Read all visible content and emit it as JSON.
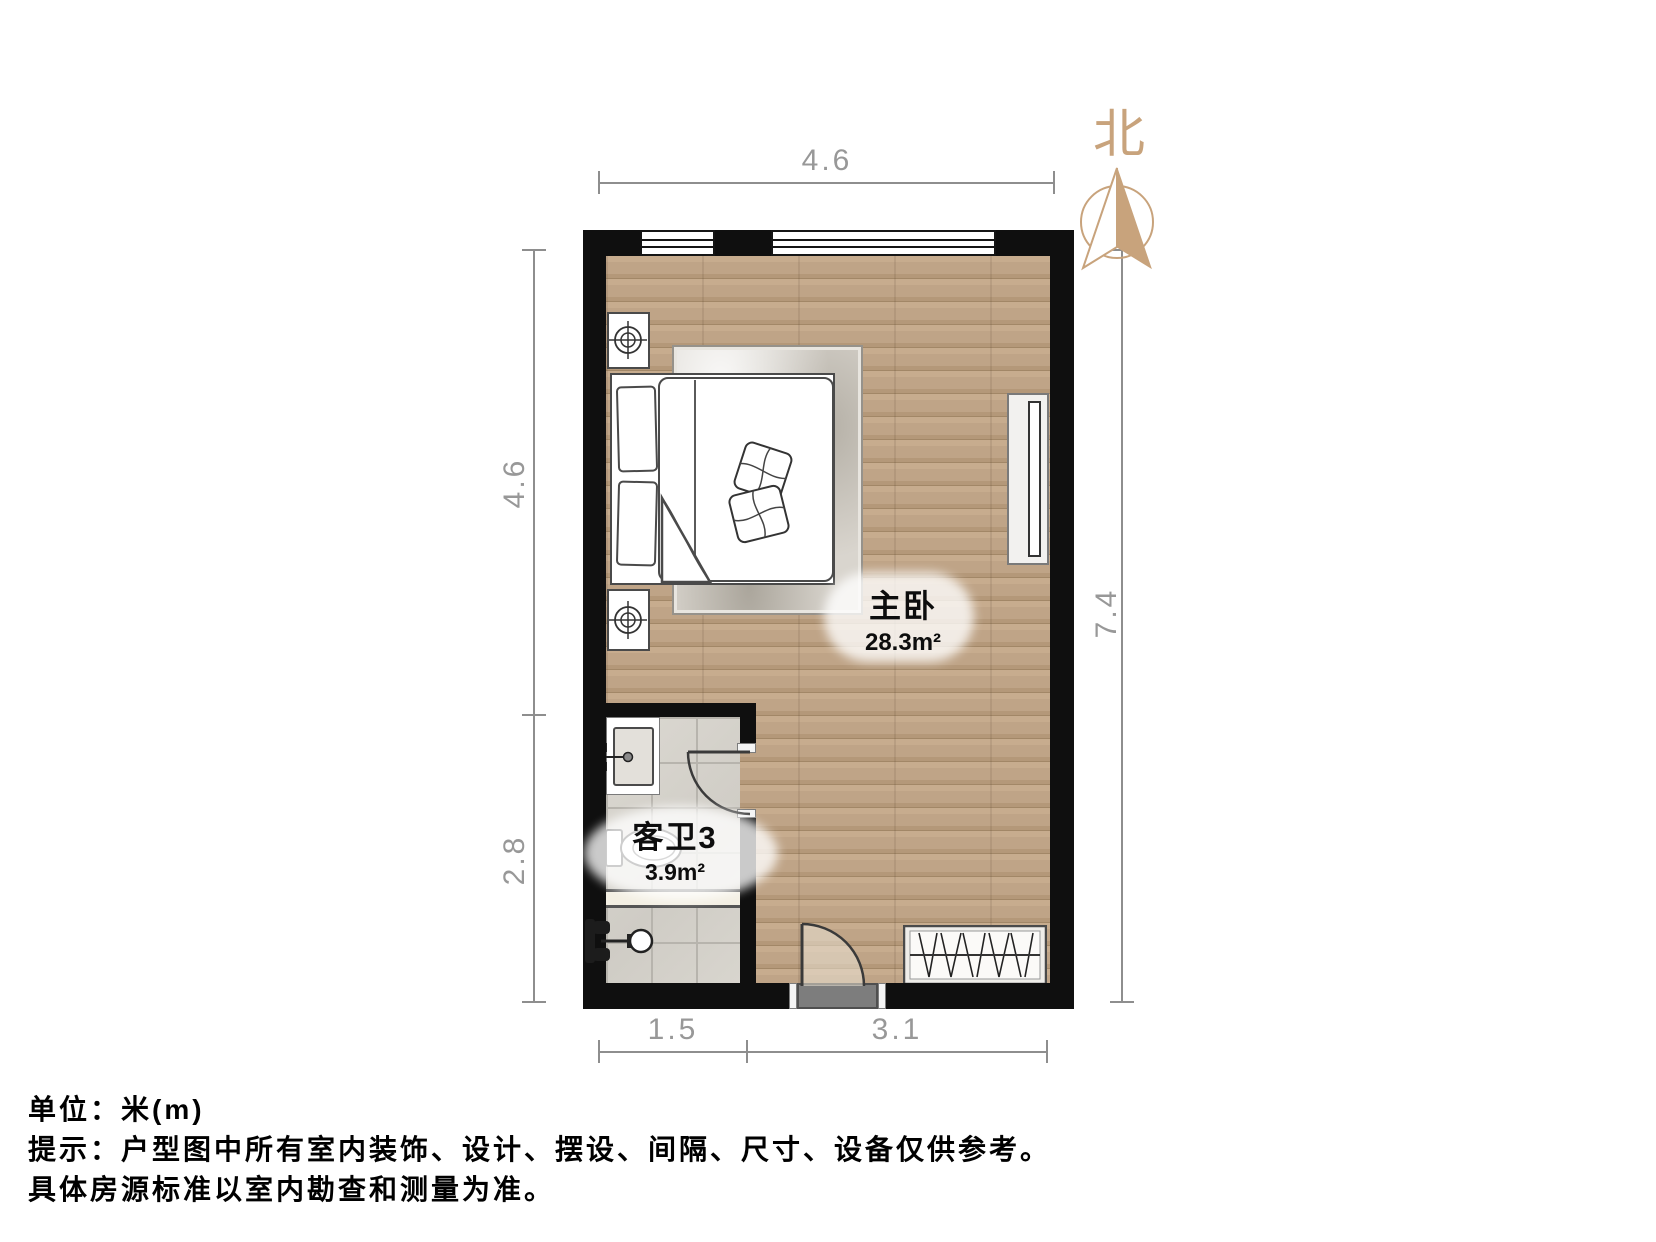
{
  "compass": {
    "label": "北"
  },
  "rooms": {
    "bedroom": {
      "name": "主卧",
      "area": "28.3m²"
    },
    "bathroom": {
      "name": "客卫3",
      "area": "3.9m²"
    }
  },
  "dimensions": {
    "top_width": "4.6",
    "left_upper": "4.6",
    "left_lower": "2.8",
    "right_height": "7.4",
    "bottom_left": "1.5",
    "bottom_right": "3.1"
  },
  "footnotes": {
    "unit": "单位：米(m)",
    "tip": "提示：户型图中所有室内装饰、设计、摆设、间隔、尺寸、设备仅供参考。",
    "tip_continued": "具体房源标准以室内勘查和测量为准。"
  },
  "icons": {
    "compass": "north-arrow-icon",
    "nightstand_lamp": "crosshair-lamp-icon",
    "toilet": "toilet-icon",
    "shower": "shower-head-icon",
    "faucet": "faucet-icon",
    "wardrobe_fill": "hanging-clothes-zigzag"
  },
  "colors": {
    "wall": "#0f0f0f",
    "wood_floor": "#bca084",
    "tile_floor": "#d6d3cc",
    "compass_accent": "#c8a37c",
    "dimension_gray": "#8e8e8e",
    "door_gray": "#7a7a7a"
  }
}
